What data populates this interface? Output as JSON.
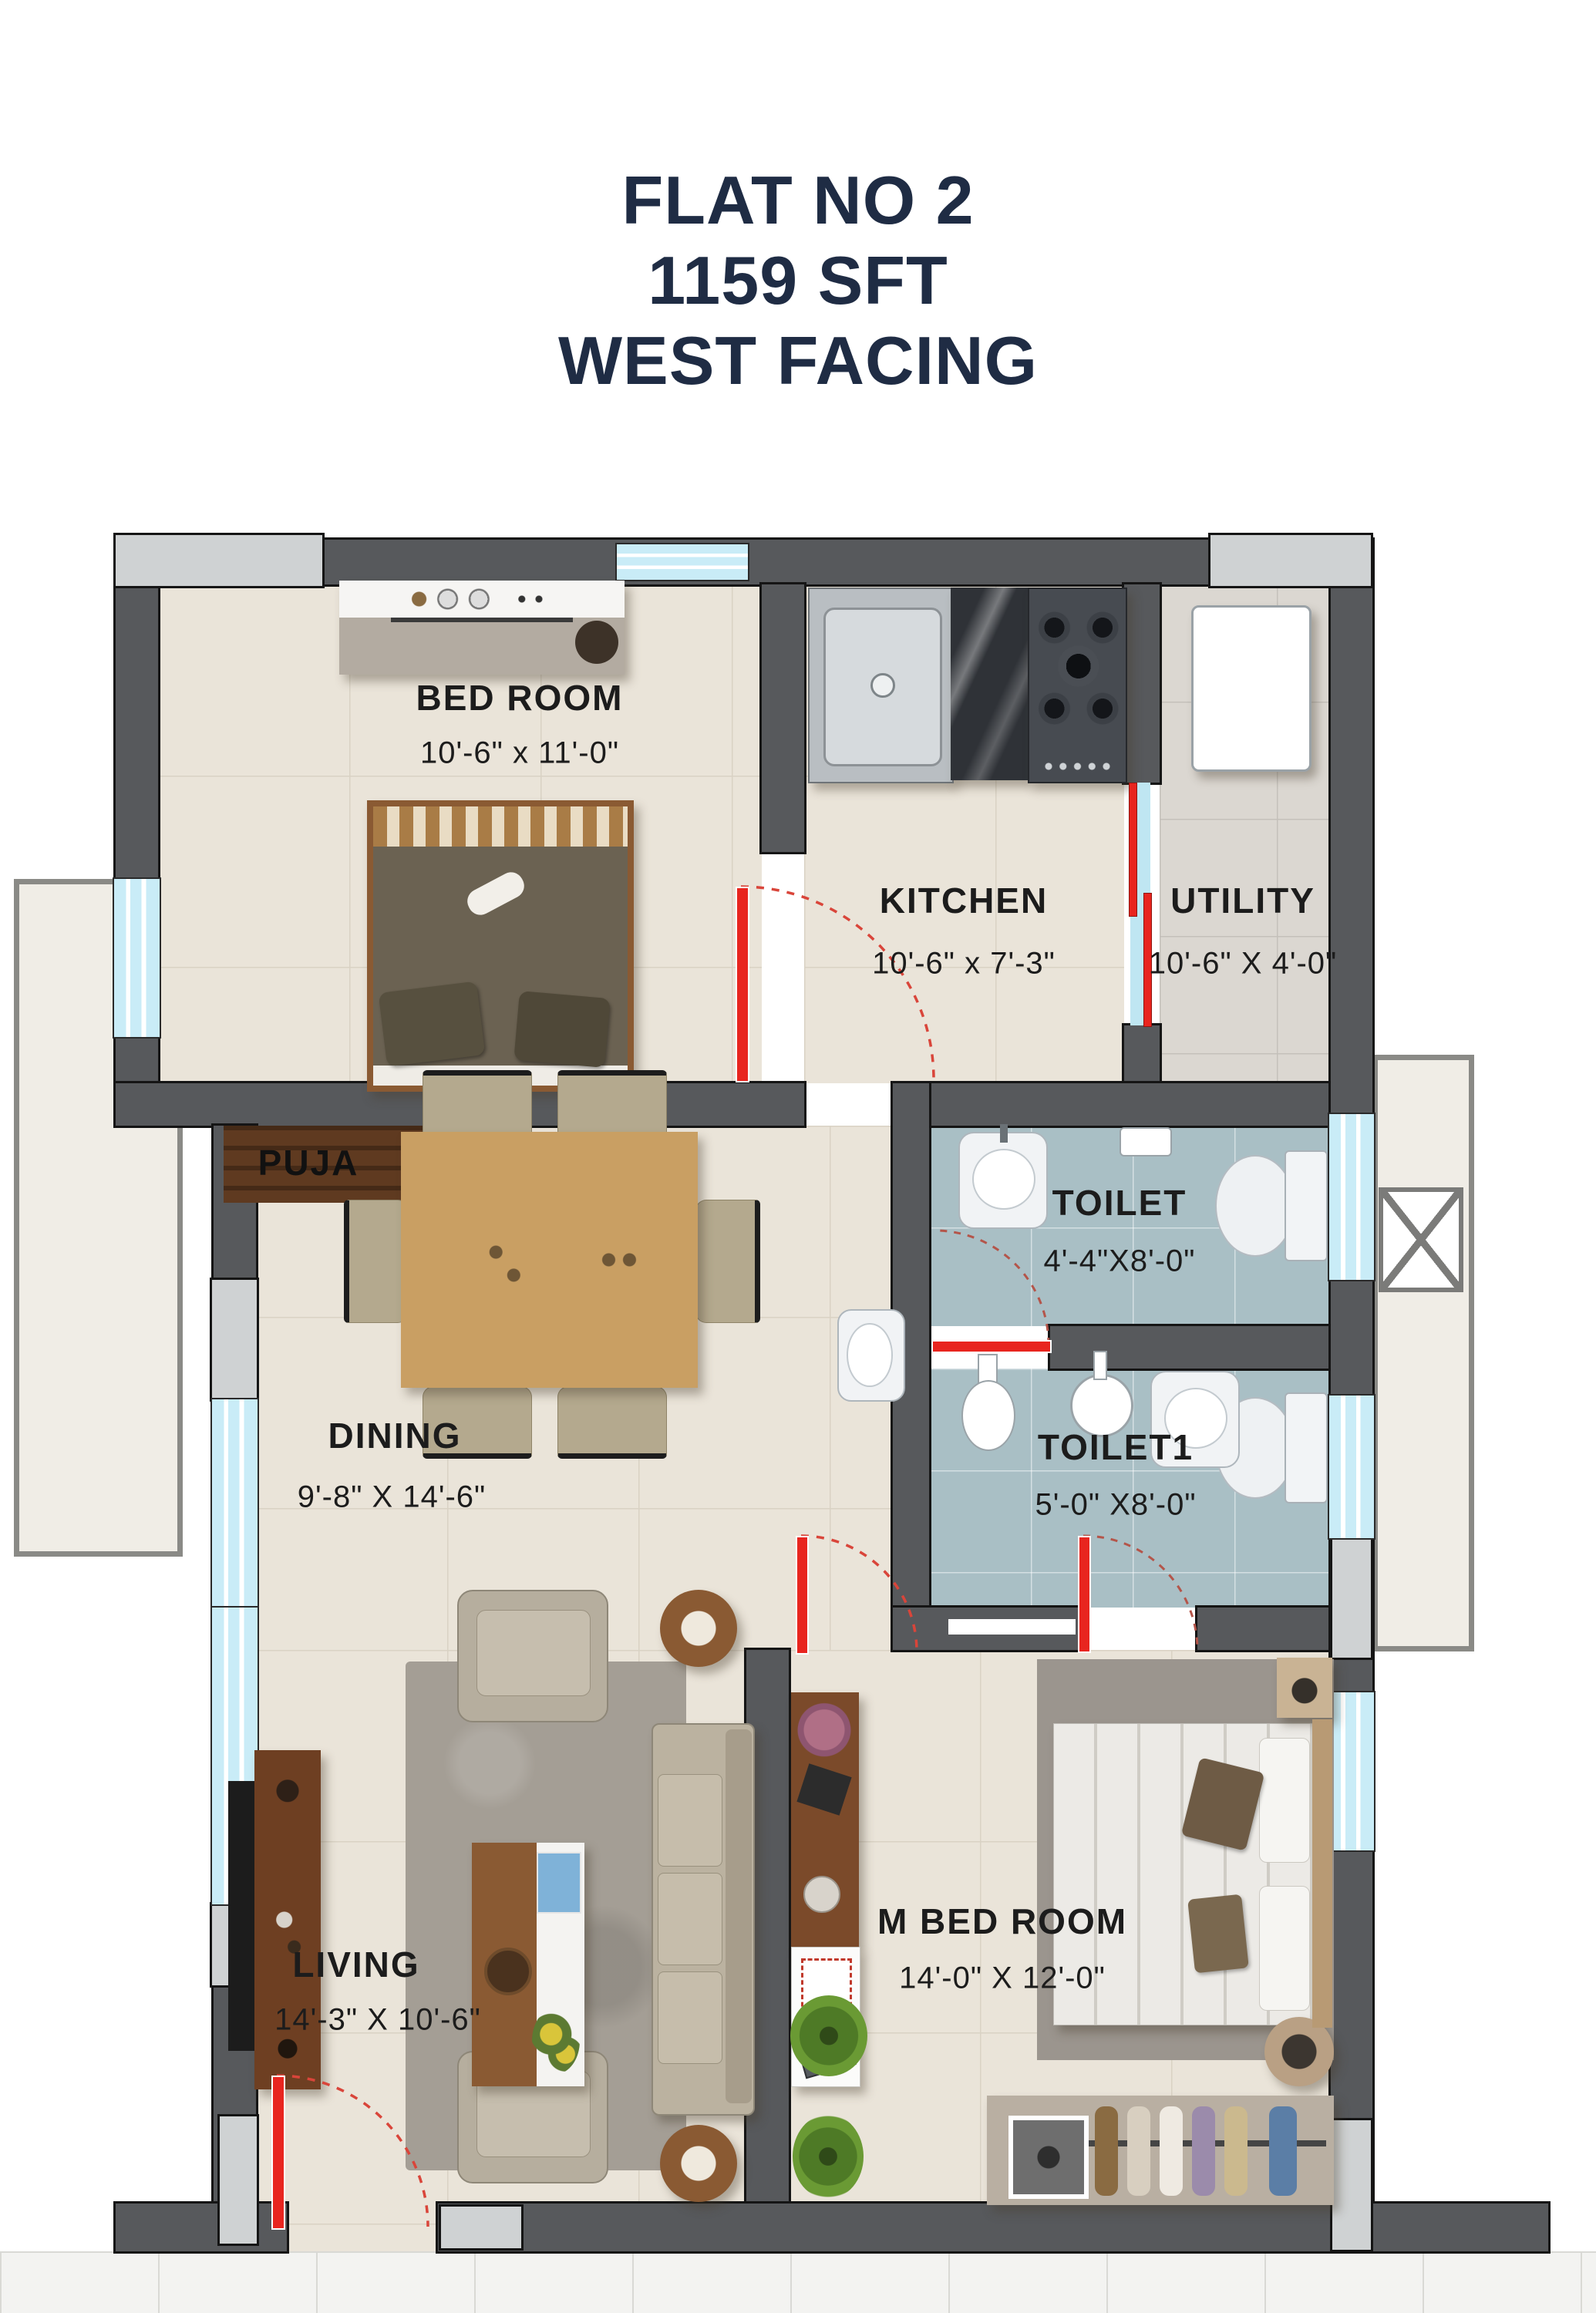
{
  "title": {
    "line1": "FLAT NO 2",
    "line2": "1159 SFT",
    "line3": "WEST FACING"
  },
  "rooms": {
    "bedroom": {
      "name": "BED ROOM",
      "dims": "10'-6\" x 11'-0\"",
      "fixtures": [
        "dresser",
        "double-bed"
      ]
    },
    "kitchen": {
      "name": "KITCHEN",
      "dims": "10'-6\" x 7'-3\"",
      "fixtures": [
        "sink",
        "granite-counter",
        "gas-stove"
      ]
    },
    "utility": {
      "name": "UTILITY",
      "dims": "10'-6\" X 4'-0\"",
      "fixtures": [
        "washing-machine"
      ]
    },
    "puja": {
      "name": "PUJA",
      "dims": "",
      "fixtures": []
    },
    "toilet": {
      "name": "TOILET",
      "dims": "4'-4\"X8'-0\"",
      "fixtures": [
        "wash-basin",
        "mixer",
        "wc"
      ]
    },
    "toilet1": {
      "name": "TOILET1",
      "dims": "5'-0\" X8'-0\"",
      "fixtures": [
        "shower",
        "wash-basin",
        "wc"
      ]
    },
    "dining": {
      "name": "DINING",
      "dims": "9'-8\" X 14'-6\"",
      "fixtures": [
        "dining-table",
        "six-chairs",
        "wash-basin"
      ]
    },
    "living": {
      "name": "LIVING",
      "dims": "14'-3\" X 10'-6\"",
      "fixtures": [
        "tv-unit",
        "rug",
        "armchairs",
        "coffee-table",
        "sofa",
        "side-tables",
        "plants"
      ]
    },
    "mbedroom": {
      "name": "M BED ROOM",
      "dims": "14'-0\" X 12'-0\"",
      "fixtures": [
        "double-bed",
        "nightstand",
        "study-desk",
        "dresser",
        "wardrobe",
        "doormat"
      ]
    }
  },
  "colors": {
    "title_text": "#1f2c44",
    "wall": "#57595c",
    "pilaster": "#cfd2d3",
    "window": "#c9ecf7",
    "floor": "#eae4d9",
    "utility_floor": "#dbd7d1",
    "toilet_floor": "#a9bfc5",
    "door_accent": "#e8251f",
    "label_text": "#1c1c1c"
  }
}
